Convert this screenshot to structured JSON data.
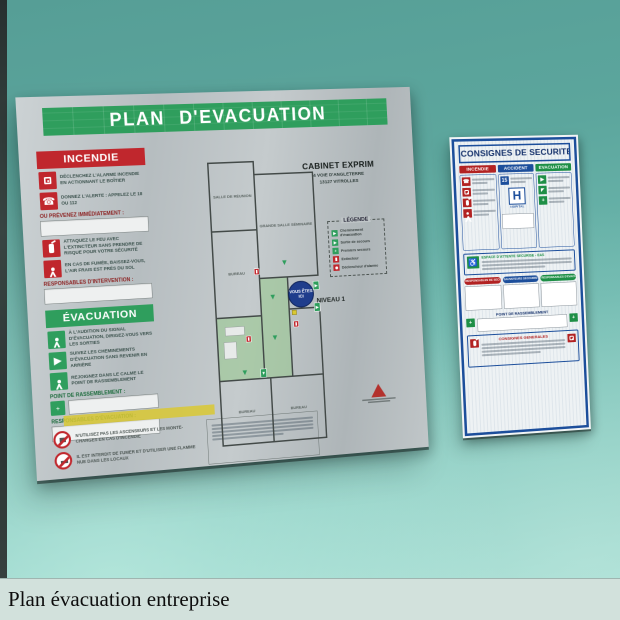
{
  "caption": {
    "text": "Plan évacuation entreprise"
  },
  "icons": {
    "phone": "☎",
    "down_arrow": "▼",
    "right_arrow": "▶",
    "cross": "+",
    "wheelchair": "♿",
    "exit_man": "▶"
  },
  "evacuation_board": {
    "title": "PLAN D'EVACUATION",
    "building": {
      "name": "CABINET EXPRIM",
      "address_line1": "4 VOIE D'ANGLETERRE",
      "address_line2": "13127 VITROLLES"
    },
    "level": "NIVEAU 1",
    "incendie": {
      "header": "INCENDIE",
      "item1": "DÉCLENCHEZ L'ALARME INCENDIE EN ACTIONNANT LE BOÎTIER",
      "item2": "DONNEZ L'ALERTE : APPELEZ LE 18 OU 112",
      "prevenez_label": "OU PRÉVENEZ IMMÉDIATEMENT :",
      "item3": "ATTAQUEZ LE FEU AVEC L'EXTINCTEUR SANS PRENDRE DE RISQUE POUR VOTRE SÉCURITÉ",
      "item4": "EN CAS DE FUMÉE, BAISSEZ-VOUS, L'AIR FRAIS EST PRÈS DU SOL",
      "responsables_label": "RESPONSABLES D'INTERVENTION :"
    },
    "evacuation": {
      "header": "ÉVACUATION",
      "item1": "À L'AUDITION DU SIGNAL D'ÉVACUATION, DIRIGEZ-VOUS VERS LES SORTIES",
      "item2": "SUIVEZ LES CHEMINEMENTS D'ÉVACUATION SANS REVENIR EN ARRIÈRE",
      "item3": "REJOIGNEZ DANS LE CALME LE POINT DE RASSEMBLEMENT",
      "point_label": "POINT DE RASSEMBLEMENT :",
      "responsables_label": "RESPONSABLES D'ÉVACUATION :"
    },
    "interdictions": {
      "item1": "N'UTILISEZ PAS LES ASCENSEURS ET LES MONTE-CHARGES EN CAS D'INCENDIE",
      "item2": "IL EST INTERDIT DE FUMER ET D'UTILISER UNE FLAMME NUE DANS LES LOCAUX"
    },
    "legend": {
      "title": "LÉGENDE",
      "item1": "Cheminement d'évacuation",
      "item2": "Sortie de secours",
      "item3": "Premiers secours",
      "item4": "Extincteur",
      "item5": "Déclencheur d'alarme"
    },
    "plan": {
      "room1": "SALLE DE RÉUNION",
      "room2": "GRANDE SALLE SÉMINAIRE",
      "room3": "BUREAU",
      "room5": "BUREAU",
      "room6": "BUREAU",
      "you_are_here": "VOUS ÊTES ICI"
    }
  },
  "consignes_board": {
    "title": "CONSIGNES DE SECURITE",
    "col1_header": "INCENDIE",
    "col2_header": "ACCIDENT",
    "col3_header": "EVACUATION",
    "samu_number": "15",
    "hospital_letter": "H",
    "hospital_label": "HOPITAL",
    "eas_title": "ESPACE D'ATTENTE SECURISE - EAS",
    "pill1": "RESPONSABLES DE SECURITE",
    "pill2": "SAUVETEURS SECOURISTES",
    "pill3": "RESPONSABLES D'EVACUATION",
    "point_label": "POINT DE RASSEMBLEMENT",
    "generales_title": "CONSIGNES GENERALES"
  }
}
